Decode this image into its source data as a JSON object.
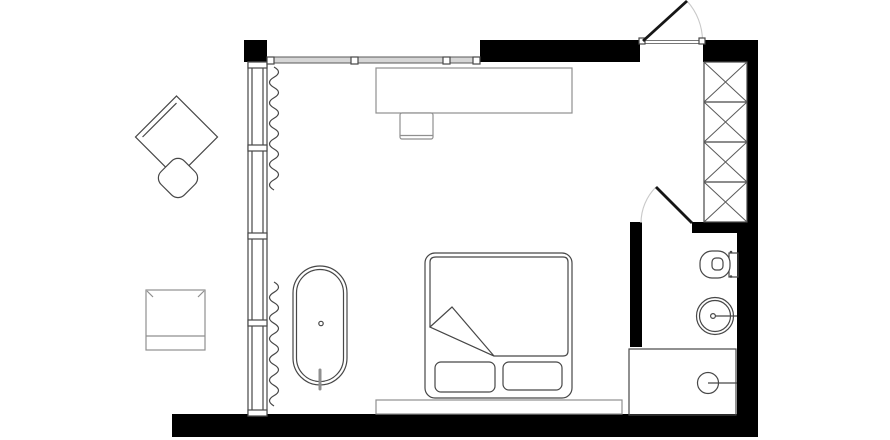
{
  "plan": {
    "kind": "bedroom-with-ensuite-floor-plan",
    "canvas": {
      "width": 890,
      "height": 440
    }
  },
  "colors": {
    "background": "#ffffff",
    "wall": "#000000",
    "line": "#474747",
    "line_light": "#8f8f8f",
    "swing_arc": "#c9c9c9",
    "window_fill": "#d6d6d6"
  },
  "shapes": {
    "curtain_upper": "M274 67 q9 5.12 0 10.25 q-9 5.12 0 10.25 q9 5.12 0 10.25 q-9 5.12 0 10.25 q9 5.12 0 10.25 q-9 5.12 0 10.25 q9 5.12 0 10.25 q-9 5.12 0 10.25 q9 5.12 0 10.25 q-9 5.12 0 10.25 q9 5.12 0 10.25 q-9 5.12 0 10.25",
    "curtain_lower": "M274 282 q9 5.16 0 10.33 q-9 5.16 0 10.33 q9 5.16 0 10.33 q-9 5.16 0 10.33 q9 5.16 0 10.33 q-9 5.16 0 10.33 q9 5.16 0 10.33 q-9 5.16 0 10.33 q9 5.16 0 10.33 q-9 5.16 0 10.33 q9 5.16 0 10.33 q-9 5.16 0 10.33"
  },
  "items": {
    "furniture": [
      "armchair",
      "side-table",
      "desk",
      "desk-chair",
      "bed",
      "bed-platform",
      "bathtub",
      "wardrobe"
    ],
    "fixtures": [
      "toilet",
      "sink",
      "shower"
    ],
    "openings": [
      "entry-door",
      "bathroom-door",
      "window-wall",
      "transom-window"
    ],
    "wardrobe_sections": 4,
    "window_panes": 4
  }
}
